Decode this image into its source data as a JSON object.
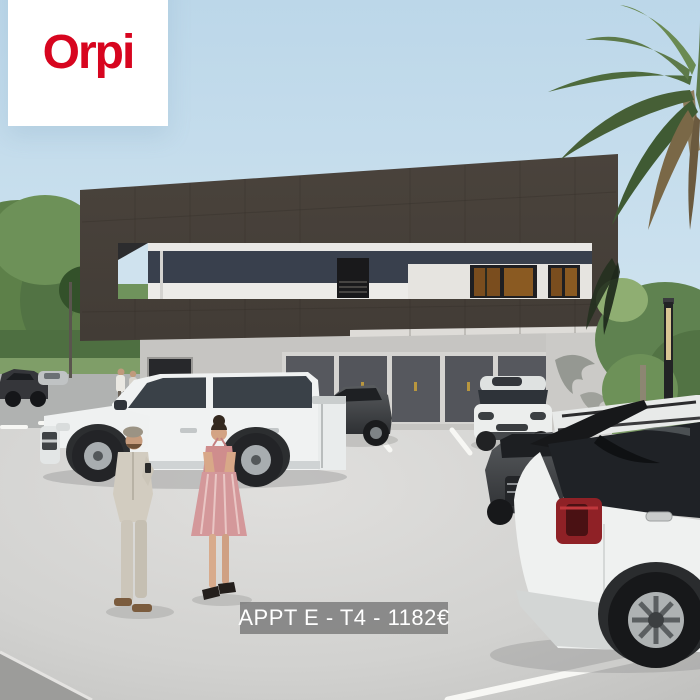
{
  "logo": {
    "brand": "Orpi",
    "brand_color": "#d7051f",
    "circle_color": "#ffffff"
  },
  "caption": {
    "text": "APPT E - T4 - 1182€",
    "text_color": "#ffffff",
    "bg_color": "#7d7d7d"
  },
  "scene": {
    "type": "3d-architectural-rendering",
    "subject": "modern two-storey apartment building with dark facade, garage doors, parking lot with five vehicles, two people talking, trees and palm tree",
    "palette": {
      "sky": "#c2dbe9",
      "facade_dark": "#474039",
      "ground_floor": "#c6c5c2",
      "garage_doors": "#56585e",
      "asphalt": "#d5d5d3",
      "foliage": "#5f8250",
      "taillight_red": "#9e2327"
    }
  }
}
